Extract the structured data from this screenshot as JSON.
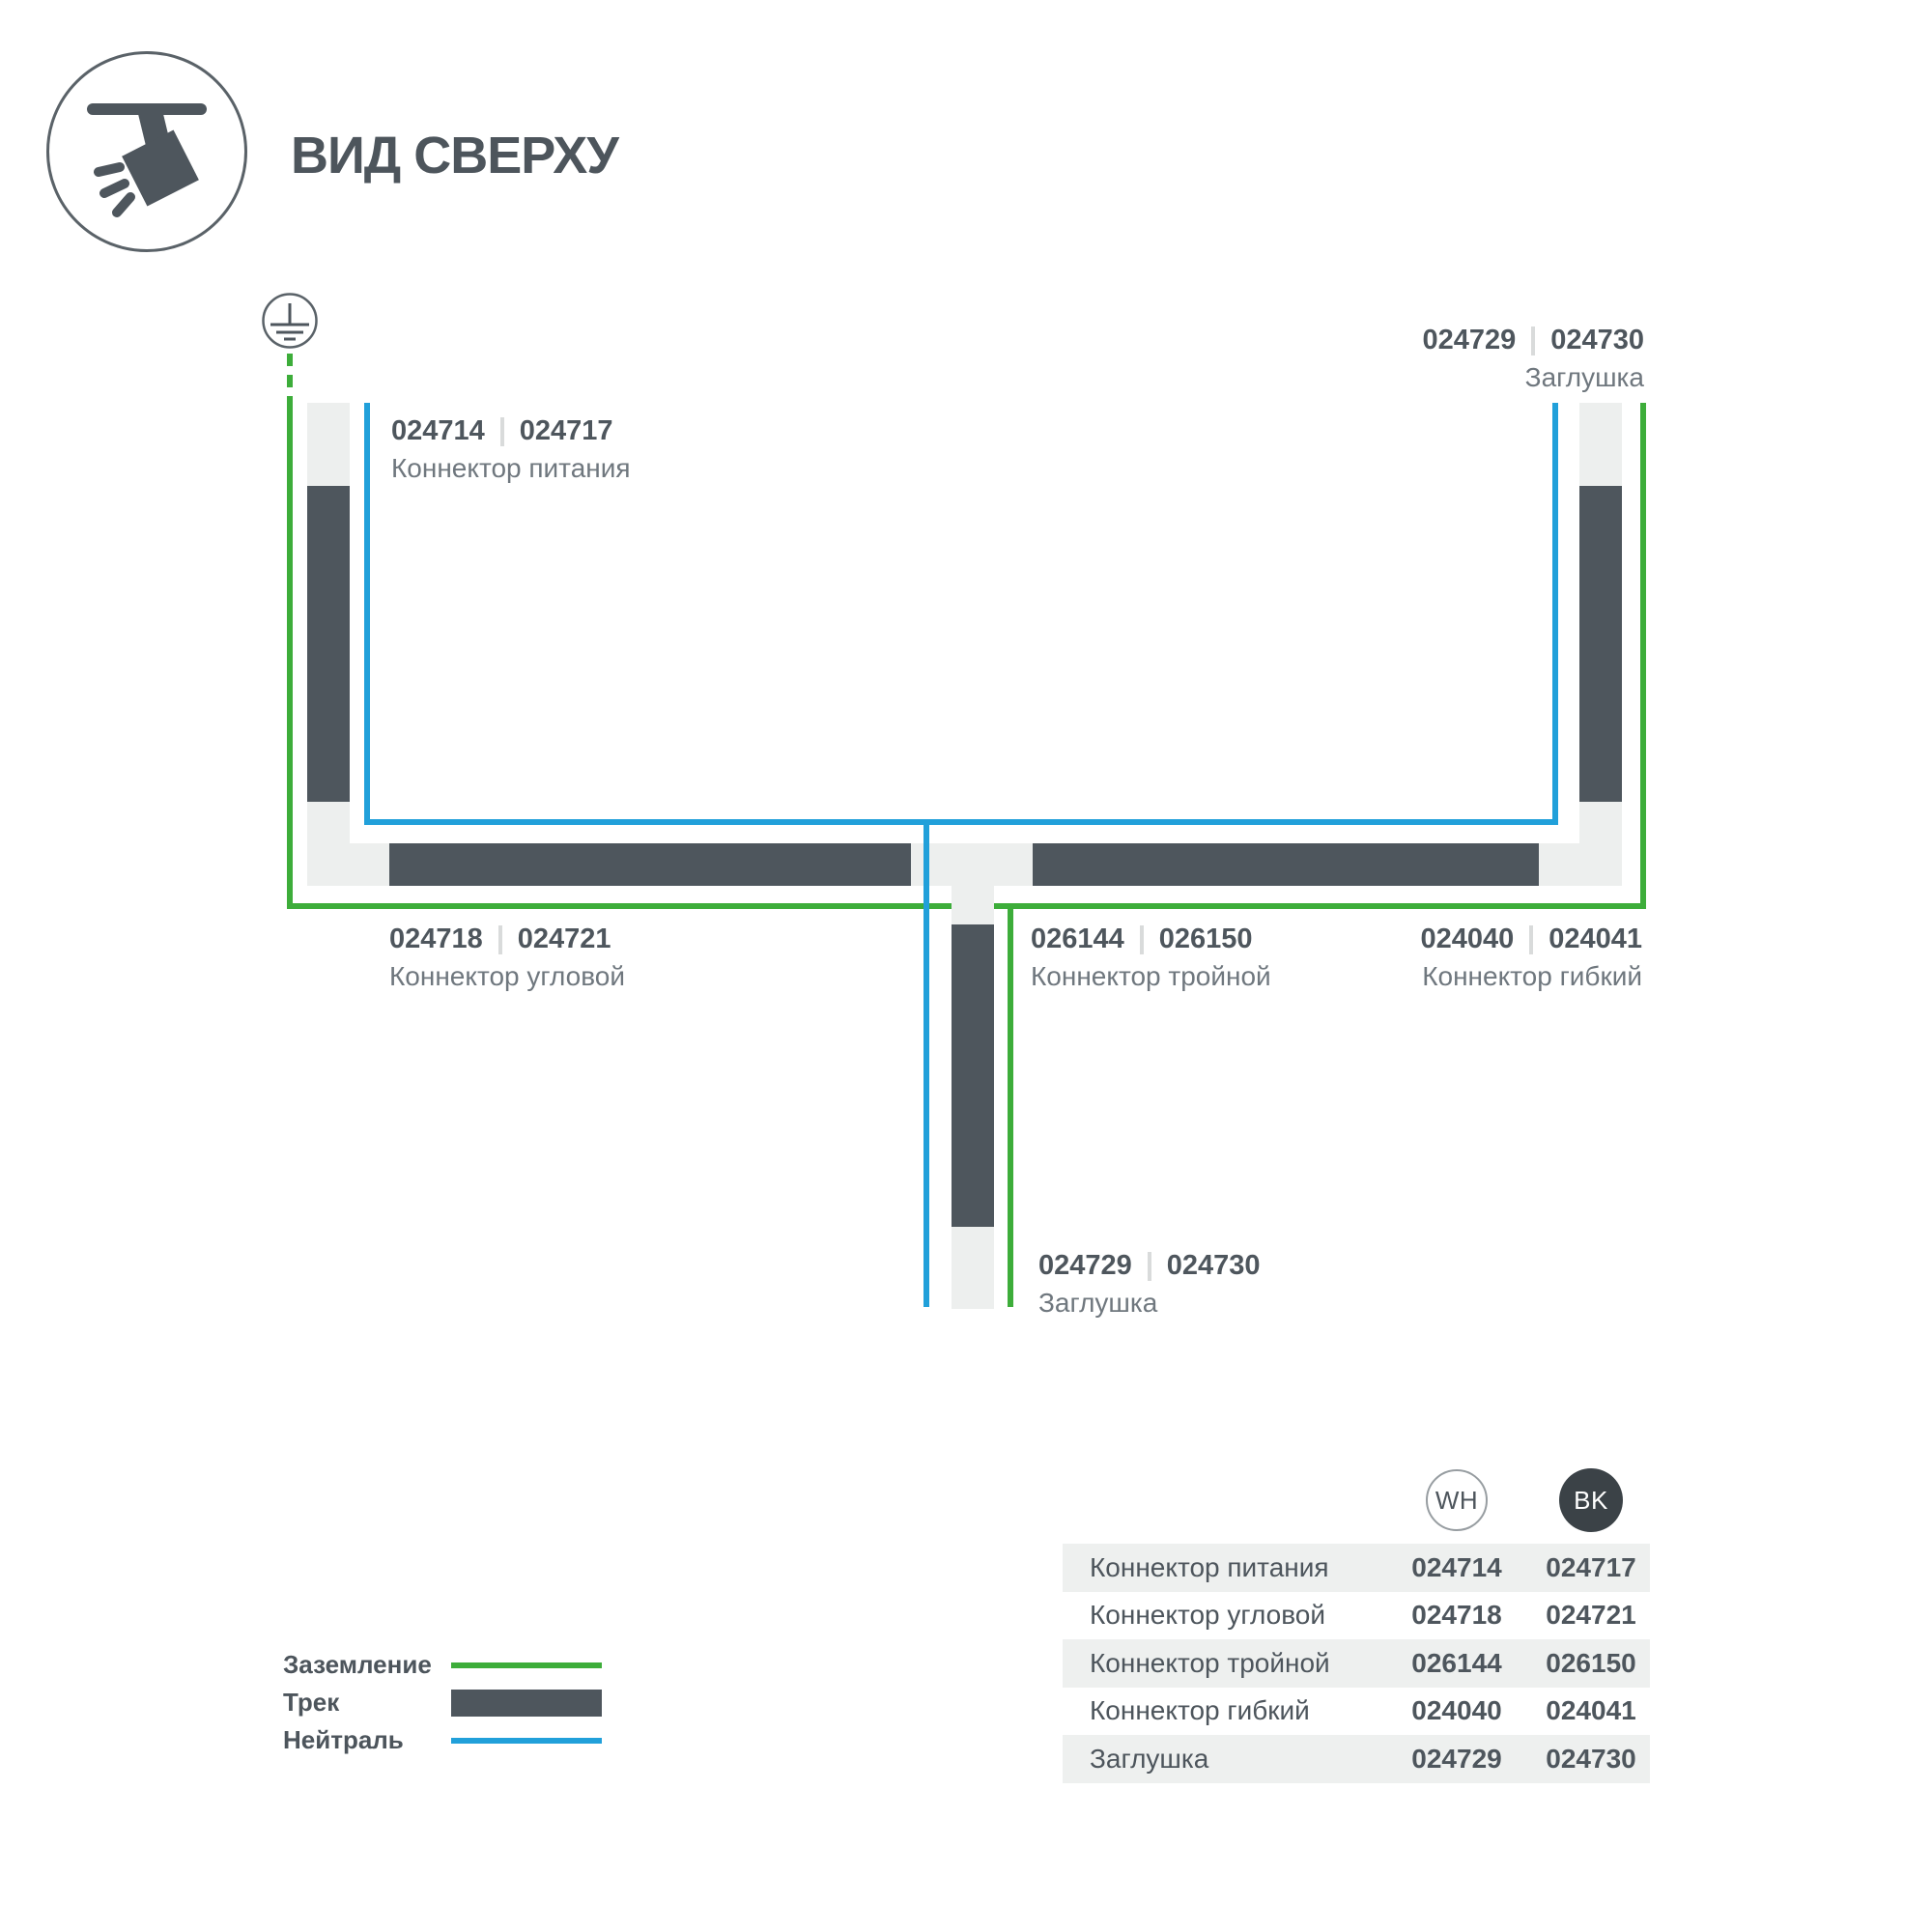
{
  "title": "ВИД СВЕРХУ",
  "colors": {
    "track_dark": "#4e565d",
    "housing_light": "#edefee",
    "ground_green": "#3dad3a",
    "neutral_blue": "#21a0da",
    "text_dark": "#4d555c",
    "text_secondary": "#6f777e",
    "table_row_bg": "#eef0ef",
    "bk_circle_bg": "#3b4247"
  },
  "icons": {
    "header": "track-spotlight-top-view-icon",
    "ground": "earth-ground-symbol"
  },
  "diagram": {
    "labels": {
      "power": {
        "code_wh": "024714",
        "code_bk": "024717",
        "name": "Коннектор питания"
      },
      "endcap_top": {
        "code_wh": "024729",
        "code_bk": "024730",
        "name": "Заглушка"
      },
      "corner": {
        "code_wh": "024718",
        "code_bk": "024721",
        "name": "Коннектор угловой"
      },
      "triple": {
        "code_wh": "026144",
        "code_bk": "026150",
        "name": "Коннектор тройной"
      },
      "flexible": {
        "code_wh": "024040",
        "code_bk": "024041",
        "name": "Коннектор гибкий"
      },
      "endcap_bottom": {
        "code_wh": "024729",
        "code_bk": "024730",
        "name": "Заглушка"
      }
    }
  },
  "legend": {
    "items": [
      {
        "label": "Заземление",
        "type": "ground"
      },
      {
        "label": "Трек",
        "type": "track"
      },
      {
        "label": "Нейтраль",
        "type": "neutral"
      }
    ]
  },
  "table": {
    "columns": [
      {
        "id": "wh",
        "label": "WH"
      },
      {
        "id": "bk",
        "label": "BK"
      }
    ],
    "rows": [
      {
        "name": "Коннектор питания",
        "wh": "024714",
        "bk": "024717"
      },
      {
        "name": "Коннектор угловой",
        "wh": "024718",
        "bk": "024721"
      },
      {
        "name": "Коннектор тройной",
        "wh": "026144",
        "bk": "026150"
      },
      {
        "name": "Коннектор гибкий",
        "wh": "024040",
        "bk": "024041"
      },
      {
        "name": "Заглушка",
        "wh": "024729",
        "bk": "024730"
      }
    ]
  }
}
